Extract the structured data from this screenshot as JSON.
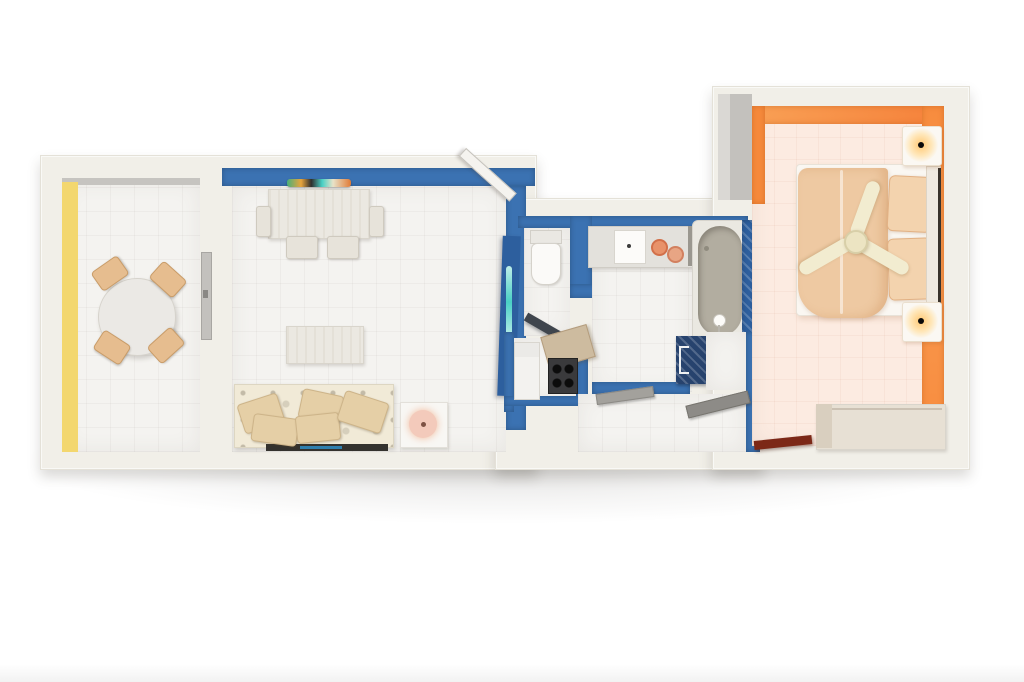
{
  "scene": {
    "kind": "3d-floor-plan-top-view",
    "description": "Top-down 3D render of a one-bedroom apartment: dining room with round table, blue living room with sofa and desk, central WC / kitchenette / bathroom with tub, hallway, and orange bedroom with double bed, ceiling fan, nightstand lamps and dresser",
    "background": "#ffffff"
  },
  "palette": {
    "outer_wall": "#f1efe8",
    "inner_gray": "#c3c1bd",
    "inner_gray_light": "#dad8d4",
    "accent_yellow": "#f3d76f",
    "accent_blue": "#3b72b2",
    "accent_blue_dark": "#2d5f9e",
    "accent_navy": "#27436e",
    "accent_orange": "#f68a3c",
    "floor_white": "#f4f3f0",
    "floor_warm": "#fcebe1",
    "wood_light": "#e7e0d4",
    "wood_side": "#d9cfbf",
    "sofa_cream": "#f1ead7",
    "pillow_tan": "#e5cfa6",
    "tub_gray": "#b2ada0",
    "teal_glass": "#49d0c5",
    "door_dark": "#3f454d",
    "door_red": "#7c2817",
    "table_white": "#ebe9e5",
    "blanket_tan": "#eec9a2",
    "pillow_peach": "#f3d3ae",
    "fan_cream": "#f2ecd0",
    "lamp_pink": "#f3cabb",
    "counter_gray": "#e3e1dc",
    "stove_dark": "#3a3a3c",
    "shelf_gray": "#a3a19c"
  },
  "rooms": [
    {
      "name": "dining-room",
      "accent": "yellow",
      "furniture": [
        "round-dining-table",
        "dining-chair",
        "dining-chair",
        "dining-chair",
        "dining-chair",
        "sliding-door"
      ]
    },
    {
      "name": "living-room",
      "accent": "blue",
      "furniture": [
        "colorful-wall-shelf",
        "desk-table",
        "desk-chairs",
        "coffee-table",
        "sofa-with-pillows",
        "side-table",
        "table-lamp",
        "open-white-door",
        "open-blue-glass-door"
      ]
    },
    {
      "name": "wc",
      "accent": "blue",
      "furniture": [
        "toilet",
        "open-dark-door"
      ]
    },
    {
      "name": "kitchenette",
      "accent": "blue",
      "furniture": [
        "fridge",
        "gas-stove",
        "range-hood"
      ]
    },
    {
      "name": "bathroom",
      "accent": "blue",
      "furniture": [
        "vanity-counter",
        "sink",
        "towel-rolls",
        "bathtub",
        "shower-head"
      ]
    },
    {
      "name": "hallway",
      "accent": "blue",
      "furniture": [
        "wall-shelf",
        "wall-shelf",
        "storage-cabinet",
        "open-red-door"
      ]
    },
    {
      "name": "bedroom",
      "accent": "orange",
      "furniture": [
        "double-bed",
        "blanket",
        "pillows",
        "headboard",
        "nightstand-with-lamp",
        "nightstand-with-lamp",
        "ceiling-fan",
        "dresser"
      ]
    }
  ]
}
